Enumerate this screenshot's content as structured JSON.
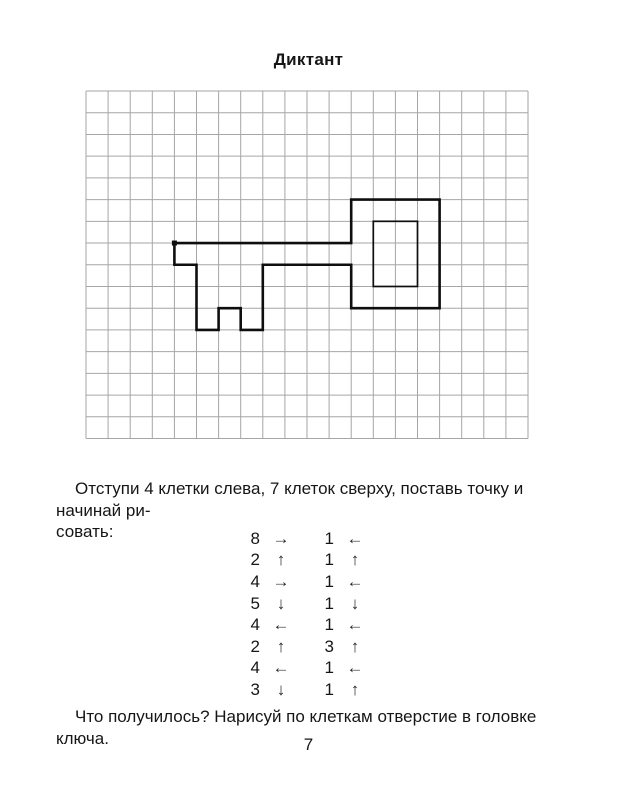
{
  "page": {
    "title": "Диктант",
    "instruction_line1": "Отступи 4 клетки слева, 7 клеток сверху, поставь точку и начинай ри-",
    "instruction_line2": "совать:",
    "question": "Что получилось? Нарисуй по клеткам отверстие в головке ключа.",
    "page_number": "7"
  },
  "colors": {
    "background": "#ffffff",
    "text": "#161616",
    "grid_line": "#a6a6a6",
    "figure_stroke": "#0e0e0e"
  },
  "grid": {
    "columns": 20,
    "rows": 16,
    "cell_width": 22.1,
    "cell_height": 21.72
  },
  "figure": {
    "name": "key-outline",
    "start_point": {
      "col": 4,
      "row": 7
    },
    "outline_points": [
      [
        4,
        7
      ],
      [
        12,
        7
      ],
      [
        12,
        5
      ],
      [
        16,
        5
      ],
      [
        16,
        10
      ],
      [
        12,
        10
      ],
      [
        12,
        8
      ],
      [
        8,
        8
      ],
      [
        8,
        11
      ],
      [
        7,
        11
      ],
      [
        7,
        10
      ],
      [
        6,
        10
      ],
      [
        6,
        11
      ],
      [
        5,
        11
      ],
      [
        5,
        8
      ],
      [
        4,
        8
      ]
    ],
    "inner_rect": {
      "from": [
        13,
        6
      ],
      "to": [
        15,
        9
      ]
    }
  },
  "dictation": {
    "left_column": [
      {
        "count": "8",
        "dir": "right",
        "arrow": "→"
      },
      {
        "count": "2",
        "dir": "up",
        "arrow": "↑"
      },
      {
        "count": "4",
        "dir": "right",
        "arrow": "→"
      },
      {
        "count": "5",
        "dir": "down",
        "arrow": "↓"
      },
      {
        "count": "4",
        "dir": "left",
        "arrow": "←"
      },
      {
        "count": "2",
        "dir": "up",
        "arrow": "↑"
      },
      {
        "count": "4",
        "dir": "left",
        "arrow": "←"
      },
      {
        "count": "3",
        "dir": "down",
        "arrow": "↓"
      }
    ],
    "right_column": [
      {
        "count": "1",
        "dir": "left",
        "arrow": "←"
      },
      {
        "count": "1",
        "dir": "up",
        "arrow": "↑"
      },
      {
        "count": "1",
        "dir": "left",
        "arrow": "←"
      },
      {
        "count": "1",
        "dir": "down",
        "arrow": "↓"
      },
      {
        "count": "1",
        "dir": "left",
        "arrow": "←"
      },
      {
        "count": "3",
        "dir": "up",
        "arrow": "↑"
      },
      {
        "count": "1",
        "dir": "left",
        "arrow": "←"
      },
      {
        "count": "1",
        "dir": "up",
        "arrow": "↑"
      }
    ]
  }
}
